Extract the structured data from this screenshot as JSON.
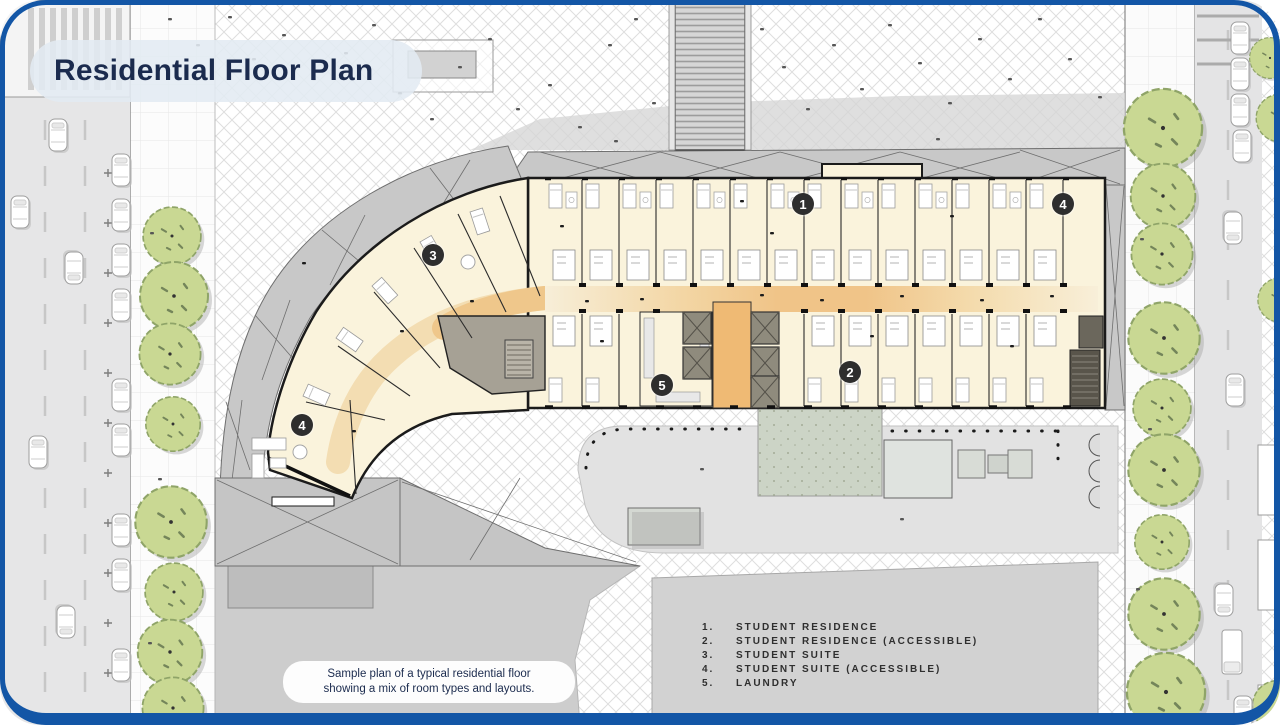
{
  "title": "Residential Floor Plan",
  "caption": {
    "line1": "Sample plan of a typical residential floor",
    "line2": "showing a mix of room types and layouts."
  },
  "legend": {
    "items": [
      {
        "num": "1.",
        "label": "STUDENT RESIDENCE"
      },
      {
        "num": "2.",
        "label": "STUDENT RESIDENCE (ACCESSIBLE)"
      },
      {
        "num": "3.",
        "label": "STUDENT SUITE"
      },
      {
        "num": "4.",
        "label": "STUDENT SUITE (ACCESSIBLE)"
      },
      {
        "num": "5.",
        "label": "LAUNDRY"
      }
    ]
  },
  "markers": {
    "items": [
      {
        "label": "1"
      },
      {
        "label": "2"
      },
      {
        "label": "3"
      },
      {
        "label": "4"
      },
      {
        "label": "4"
      },
      {
        "label": "5"
      }
    ]
  },
  "colors": {
    "frame_blue": "#1356a6",
    "title_navy": "#1b2b4e",
    "room_cream": "#faf3dc",
    "corridor_orange": "#f0c488",
    "lobby_orange": "#efba74",
    "tree_green": "#c9d893",
    "marker_dark": "#2e2e2e",
    "plaza_gray": "#d2d2d2"
  }
}
